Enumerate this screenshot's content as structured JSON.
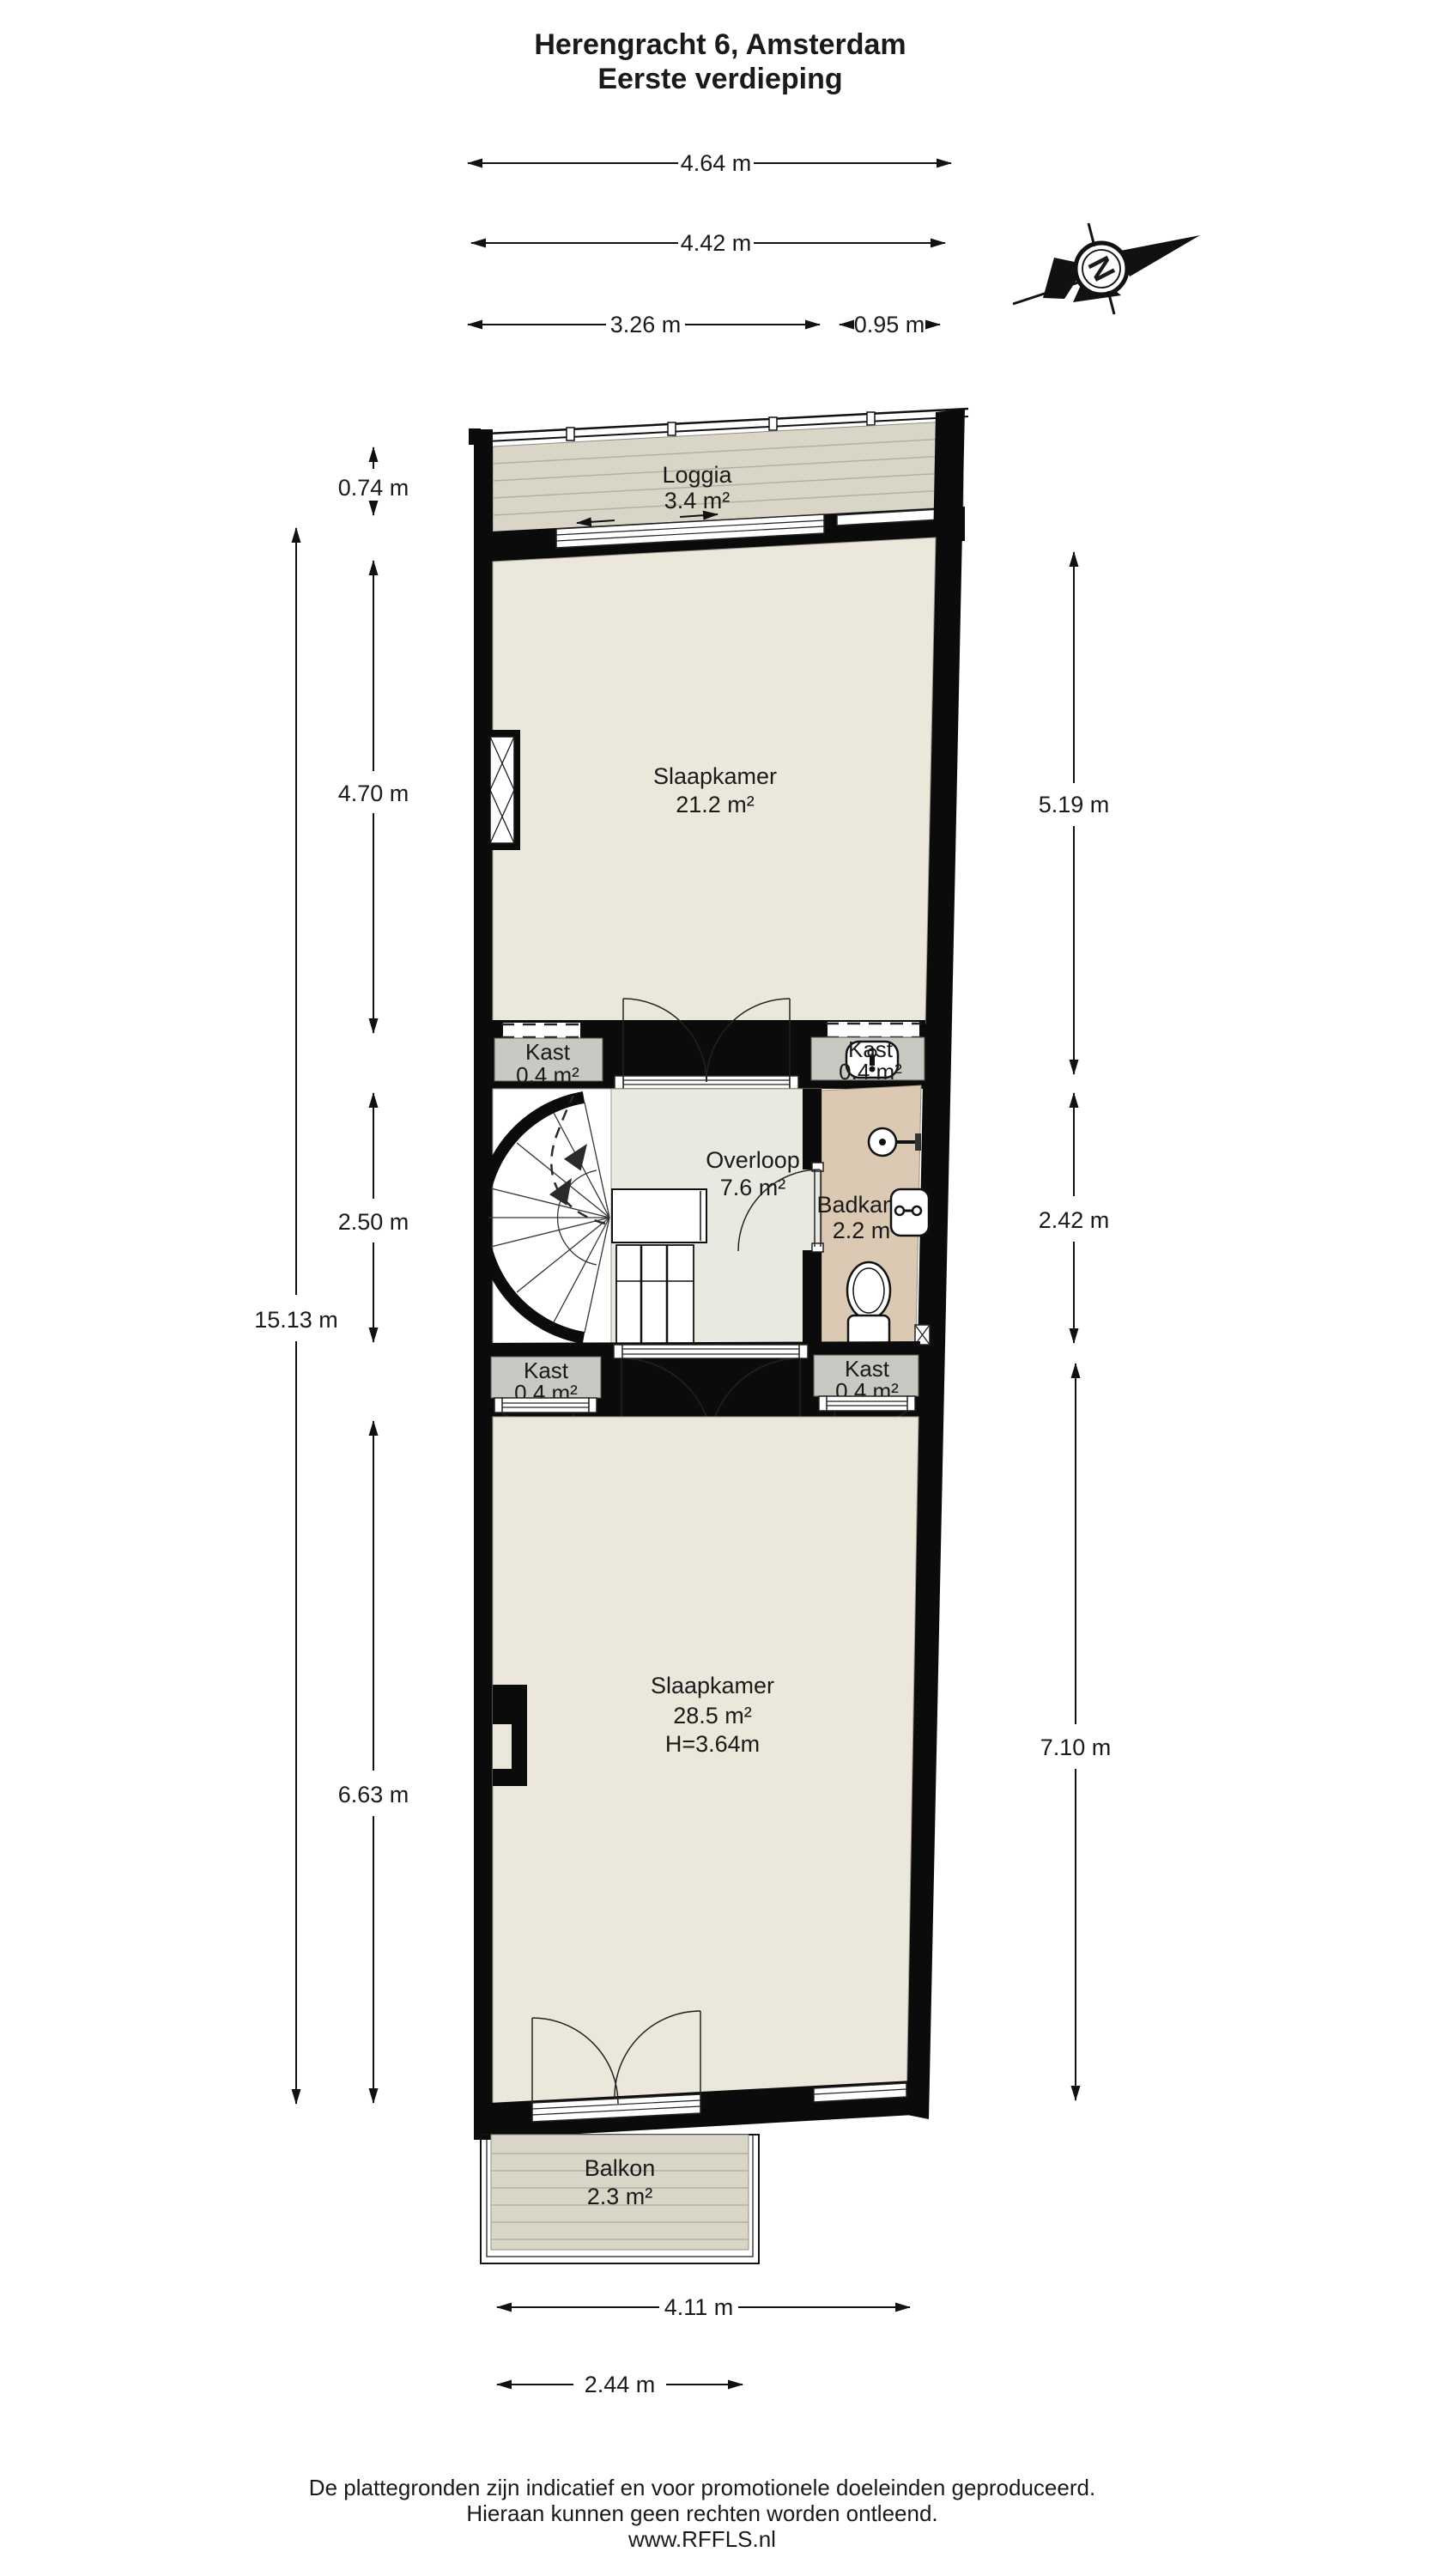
{
  "title": {
    "line1": "Herengracht 6, Amsterdam",
    "line2": "Eerste verdieping"
  },
  "compass": {
    "north_letter": "N"
  },
  "dims": {
    "top_overall": "4.64 m",
    "top_inner": "4.42 m",
    "top_left_part": "3.26 m",
    "top_right_part": "0.95 m",
    "left_loggia": "0.74 m",
    "left_slaapkamer_boven": "4.70 m",
    "left_overloop": "2.50 m",
    "left_totaal": "15.13 m",
    "left_slaapkamer_onder": "6.63 m",
    "right_slaapkamer_boven": "5.19 m",
    "right_badkamer": "2.42 m",
    "right_slaapkamer_onder": "7.10 m",
    "bottom_overall": "4.11 m",
    "bottom_balkon": "2.44 m"
  },
  "rooms": {
    "loggia": {
      "name": "Loggia",
      "area": "3.4 m²"
    },
    "slaapkamer_boven": {
      "name": "Slaapkamer",
      "area": "21.2 m²"
    },
    "kast_links_boven": {
      "name": "Kast",
      "area": "0.4 m²"
    },
    "kast_rechts_boven": {
      "name": "Kast",
      "area": "0.4 m²"
    },
    "overloop": {
      "name": "Overloop",
      "area": "7.6 m²"
    },
    "badkamer": {
      "name": "Badkamer",
      "area": "2.2 m²"
    },
    "kast_links_onder": {
      "name": "Kast",
      "area": "0.4 m²"
    },
    "kast_rechts_onder": {
      "name": "Kast",
      "area": "0.4 m²"
    },
    "slaapkamer_onder": {
      "name": "Slaapkamer",
      "area": "28.5 m²",
      "height": "H=3.64m"
    },
    "balkon": {
      "name": "Balkon",
      "area": "2.3 m²"
    }
  },
  "footer": {
    "line1": "De plattegronden zijn indicatief en voor promotionele doeleinden geproduceerd.",
    "line2": "Hieraan kunnen geen rechten worden ontleend.",
    "line3": "www.RFFLS.nl"
  },
  "colors": {
    "wall": "#0b0b0b",
    "floor": "#ece7db",
    "deck": "#d9d6c8",
    "closet": "#c9c8c3",
    "hall": "#e9e8e1",
    "bath": "#dcc9b3"
  }
}
